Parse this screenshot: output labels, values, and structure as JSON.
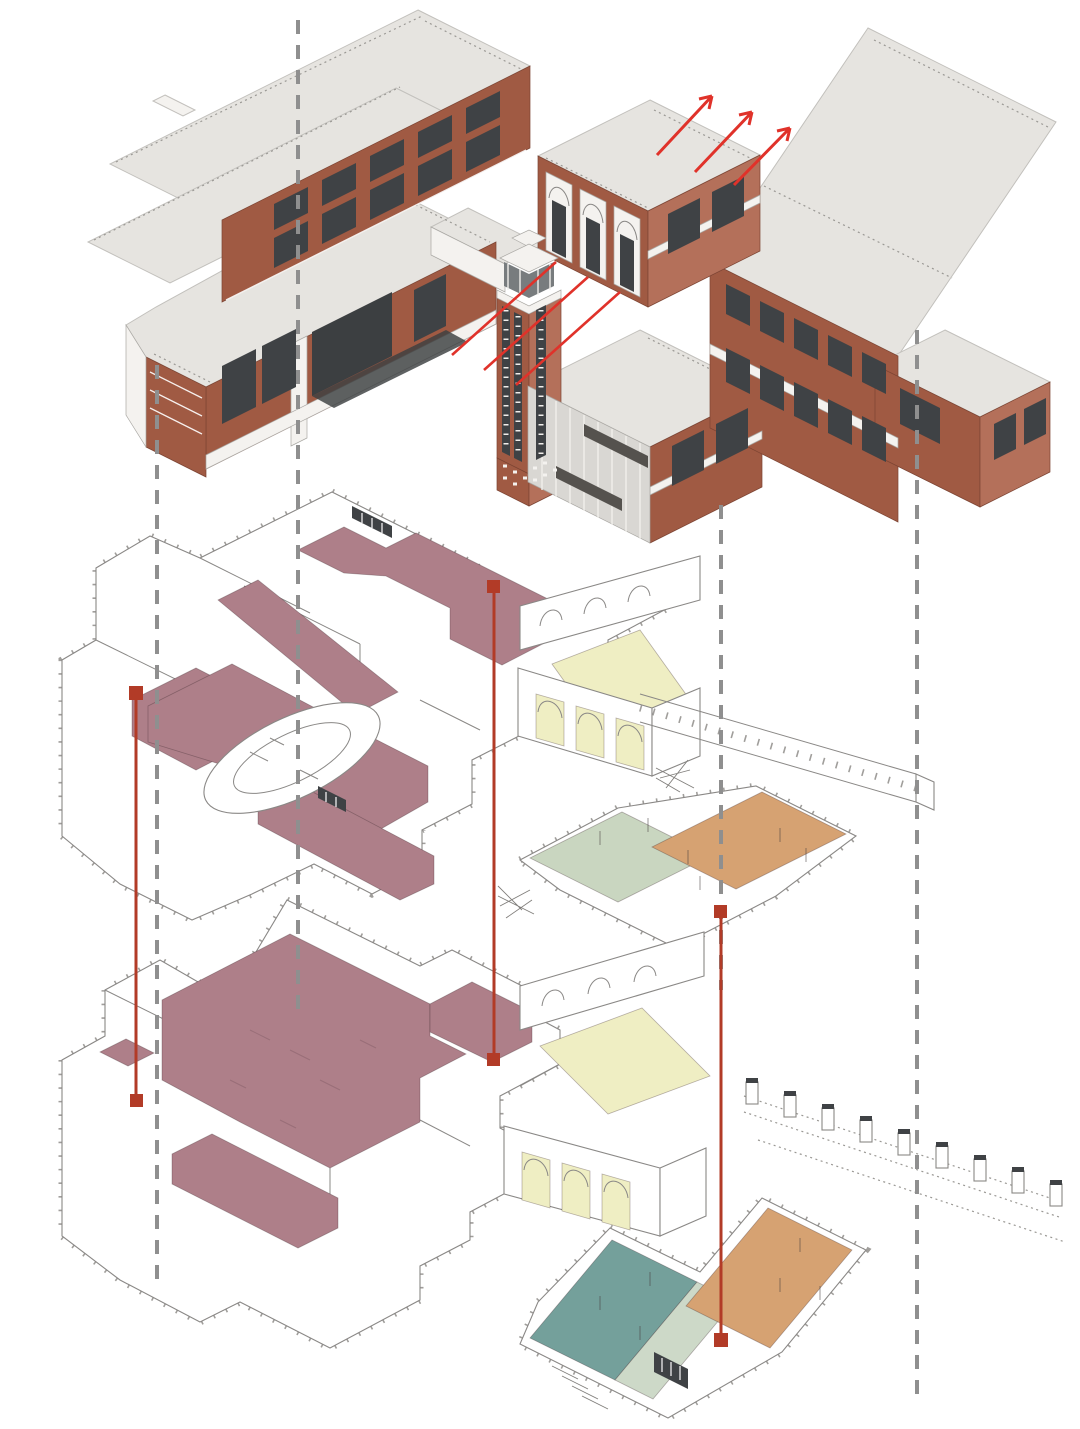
{
  "diagram": {
    "kind": "exploded-axonometric-building-diagram",
    "background": "#ffffff",
    "tiers": [
      {
        "id": "massing",
        "name": "full-building-massing",
        "features": [
          "brick-wings",
          "arched-entrance-hall",
          "campanile-tower",
          "flat-gray-roofs"
        ]
      },
      {
        "id": "upper-floor-plate",
        "name": "upper-floor-plan",
        "zones": [
          {
            "name": "mauve-corridor-and-rooms",
            "color": "#ae7f89"
          },
          {
            "name": "yellow-hall",
            "color": "#efeec3"
          },
          {
            "name": "green-room",
            "color": "#c9d6c0"
          },
          {
            "name": "orange-room",
            "color": "#d6a272"
          }
        ]
      },
      {
        "id": "ground-floor-plate",
        "name": "ground-floor-plan",
        "zones": [
          {
            "name": "mauve-rooms",
            "color": "#ae7f89"
          },
          {
            "name": "yellow-hall",
            "color": "#efeec3"
          },
          {
            "name": "teal-court",
            "color": "#74a09b"
          },
          {
            "name": "sage-corridor",
            "color": "#cdd9c8"
          },
          {
            "name": "orange-court",
            "color": "#d6a272"
          }
        ]
      }
    ],
    "guides": {
      "dashed_projection_lines": 4,
      "red_drop_lines": 3,
      "red_drop_line_end_markers": "square"
    },
    "arrows": {
      "count": 3,
      "direction": "up-right"
    },
    "leader_lines": {
      "count": 3,
      "from": "entrance-arches",
      "direction": "down-left"
    }
  },
  "palette": {
    "brick": "#a05a43",
    "brick_light": "#b4705a",
    "brick_dark": "#7c4433",
    "roof": "#e6e4e0",
    "white_trim": "#f4f2ef",
    "curtain": "#d9d7d3",
    "glass_dark": "#3f4245",
    "glass_mid": "#787c7e",
    "dark_opening": "#3c3f41",
    "canopy_dark": "#55524e",
    "floor_mauve": "#ae7f89",
    "floor_yellow": "#efeec3",
    "floor_green": "#c9d6c0",
    "floor_orange": "#d6a272",
    "floor_teal": "#74a09b",
    "floor_sage": "#cdd9c8",
    "guide_dash": "#8f8f8f",
    "guide_red": "#b23b27",
    "arrow_red": "#e0322a",
    "scribble": "#946a74"
  }
}
